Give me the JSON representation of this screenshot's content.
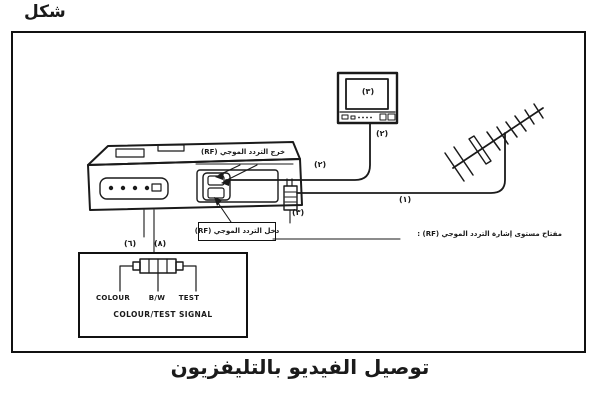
{
  "figure_label": "شكل",
  "caption": "توصيل الفيديو بالتليفزيون",
  "diagram": {
    "labels": {
      "rf_out": "خرج التردد الموجي (RF)",
      "rf_in": "دخل التردد الموجي (RF)",
      "rf_switch": "مفتاح مستوى إشارة التردد الموجي (RF) :"
    },
    "callouts": {
      "antenna_cable": "(١)",
      "tv_cable": "(٢)",
      "tv_screen": "(٣)",
      "tv_terminal": "(٢)",
      "plug": "(٣)",
      "panel_left": "(٦)",
      "panel_right": "(٨)"
    },
    "signal_box": {
      "options": [
        "COLOUR",
        "B/W",
        "TEST"
      ],
      "title": "COLOUR/TEST SIGNAL"
    },
    "ink_color": "#1a1a1a"
  }
}
